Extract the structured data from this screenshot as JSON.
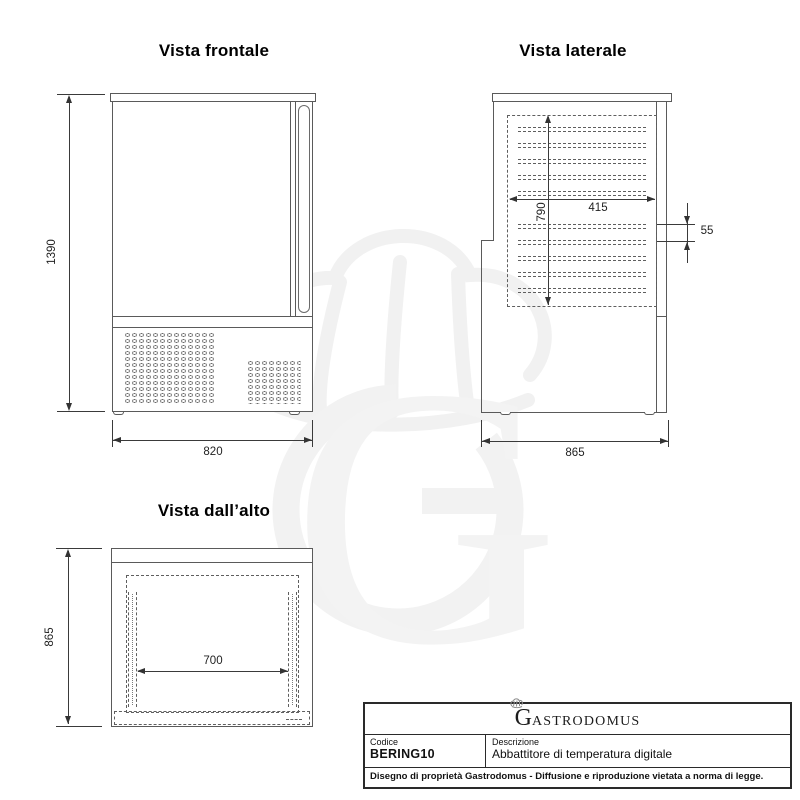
{
  "front": {
    "title": "Vista frontale",
    "height_mm": "1390",
    "width_mm": "820"
  },
  "side": {
    "title": "Vista laterale",
    "chamber_height_mm": "790",
    "chamber_depth_mm": "415",
    "shelf_pitch_mm": "55",
    "depth_mm": "865"
  },
  "top": {
    "title": "Vista dall’alto",
    "depth_mm": "865",
    "rail_span_mm": "700"
  },
  "title_block": {
    "logo_initial": "G",
    "logo_rest": "ASTRODOMUS",
    "codice_label": "Codice",
    "codice_value": "BERING10",
    "descrizione_label": "Descrizione",
    "descrizione_value": "Abbattitore di temperatura digitale",
    "disclaimer": "Disegno di proprietà Gastrodomus -  Diffusione e riproduzione vietata a norma di legge."
  },
  "watermark": {
    "letter": "G"
  },
  "colors": {
    "line": "#5a5a5a",
    "dimension": "#333333",
    "text": "#111111",
    "watermark": "#f2f2f2",
    "background": "#ffffff"
  }
}
